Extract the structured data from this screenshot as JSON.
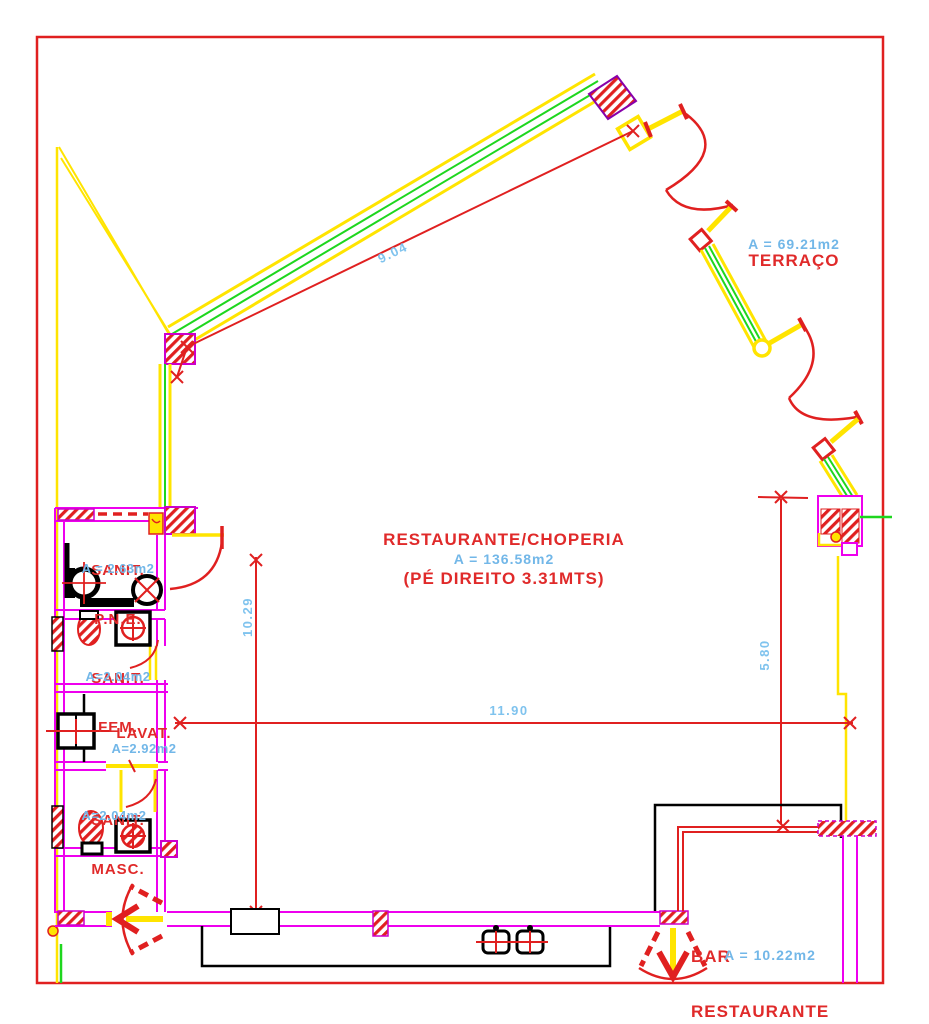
{
  "drawing": {
    "type": "architectural-floor-plan",
    "rooms": {
      "terraco": {
        "name": "TERRAÇO",
        "area": "A = 69.21m2"
      },
      "restaurante": {
        "name": "RESTAURANTE/CHOPERIA",
        "area": "A = 136.58m2",
        "note": "(PÉ DIREITO 3.31MTS)"
      },
      "sanit_pne": {
        "line1": "SANIT.",
        "line2": "P.N.E.",
        "area": "A = 2.63m2"
      },
      "sanit_fem": {
        "line1": "SANIT.",
        "line2": "FEM.",
        "area": "A=2.04m2"
      },
      "lavat": {
        "line1": "LAVAT.",
        "area": "A=2.92m2"
      },
      "sanit_masc": {
        "line1": "SANIT.",
        "line2": "MASC.",
        "area": "A=2.04m2"
      },
      "bar": {
        "line1": "BAR",
        "line2": "RESTAURANTE",
        "area": "A = 10.22m2"
      }
    },
    "dimensions": {
      "diagonal_wall": "9.04",
      "left_vertical": "10.29",
      "bottom_horizontal": "11.90",
      "right_vertical": "5.80"
    },
    "colors": {
      "wall_magenta": "#ee00ee",
      "structure_yellow": "#ffe400",
      "structure_green": "#1ed61e",
      "line_red": "#e02020",
      "label_red": "#e02a2a",
      "label_blue": "#72b7e8",
      "fixture_black": "#000000"
    }
  }
}
